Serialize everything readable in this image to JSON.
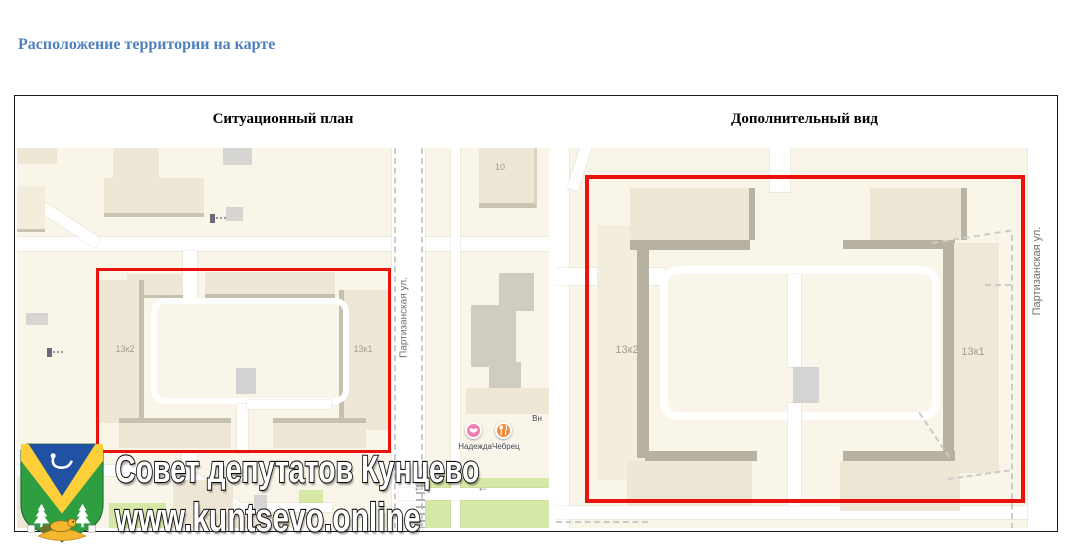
{
  "title": "Расположение территории на карте",
  "panels": [
    {
      "title": "Ситуационный план"
    },
    {
      "title": "Дополнительный вид"
    }
  ],
  "situational_map": {
    "street_label": "Партизанская ул.",
    "building_13k2": "13к2",
    "building_13k1": "13к1",
    "building_10": "10",
    "poi_label": "НадеждаЧебрец",
    "poi_partial_label": "Вн",
    "road_arrow": "←"
  },
  "additional_map": {
    "street_label": "Партизанская ул.",
    "building_13k2": "13к2",
    "building_13k1": "13к1"
  },
  "watermark": {
    "line1": "Совет депутатов Кунцево",
    "line2": "www.kuntsevo.online"
  },
  "colors": {
    "title_blue": "#4f81bd",
    "boundary_red": "#e9130b",
    "map_background": "#f9f5e9",
    "building_beige": "#efe7d6",
    "building_gray": "#d6d5d1",
    "green_area": "#d6e8a6",
    "logo_green": "#2f9e41",
    "logo_yellow": "#ffcf3a",
    "logo_blue": "#2051a3"
  }
}
